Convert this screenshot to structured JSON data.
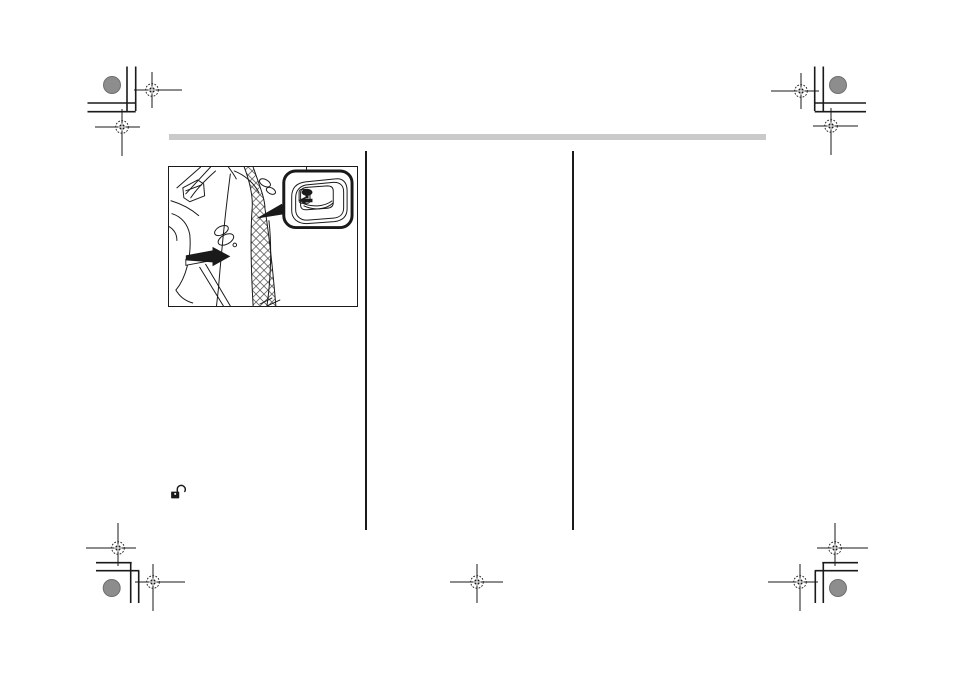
{
  "colors": {
    "paper": "#ffffff",
    "ink": "#1a1a1a",
    "rule_gray": "#cacaca",
    "granite_gray": "#8d8d8d",
    "granite_edge": "#6f6f6f"
  },
  "icons": {
    "unlock": "open-padlock-icon",
    "figure": "car-front-door-with-inner-handle-lock-knob-callout",
    "registration": "print-registration-crosshair-mark"
  }
}
